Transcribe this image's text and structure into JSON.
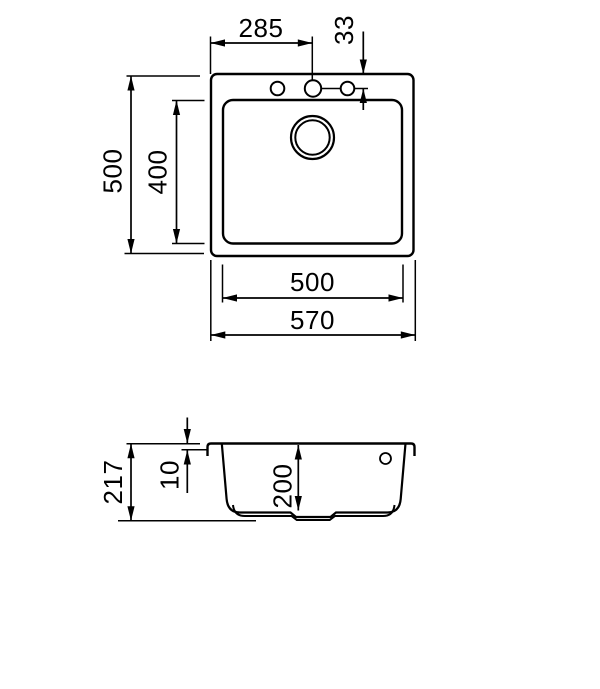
{
  "colors": {
    "line": "#000000",
    "background": "#ffffff"
  },
  "top_view": {
    "hole_spacing_horizontal": "285",
    "hole_offset_from_edge": "33",
    "overall_depth": "500",
    "bowl_depth": "400",
    "bowl_width": "500",
    "overall_width": "570"
  },
  "section_view": {
    "total_height": "217",
    "rim_height": "10",
    "bowl_inner_depth": "200"
  }
}
